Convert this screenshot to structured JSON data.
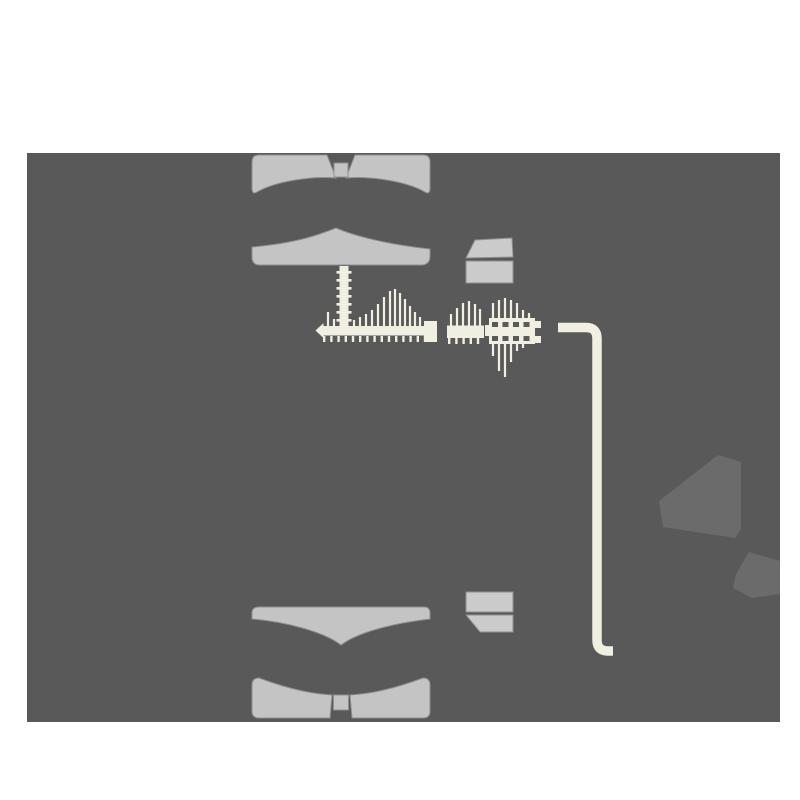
{
  "meta": {
    "description": "Exploded hardware assembly diagram of a clamp / mount kit on a dark panel",
    "canvas_width": 800,
    "canvas_height": 800,
    "text_visible": false
  },
  "colors": {
    "page_bg": "#ffffff",
    "panel_bg": "#595959",
    "part_gray": "#c4c4c4",
    "block_gray": "#cbcbcb",
    "hardware_cream": "#f1eee2",
    "shadow_gray": "#6b6b6b"
  },
  "parts": [
    {
      "id": "top-clamp-outer",
      "kind": "bowtie-pad"
    },
    {
      "id": "top-clamp-inner",
      "kind": "peaked-plate"
    },
    {
      "id": "vertical-machine-screw",
      "kind": "threaded-rod"
    },
    {
      "id": "horizontal-lag-screw",
      "kind": "threaded-screw"
    },
    {
      "id": "thread-nut",
      "kind": "nut"
    },
    {
      "id": "short-screw-segment",
      "kind": "threaded-screw"
    },
    {
      "id": "ribbed-wall-anchor",
      "kind": "anchor-plug"
    },
    {
      "id": "spacer-block-top",
      "kind": "block-3d"
    },
    {
      "id": "hex-key",
      "kind": "allen-wrench"
    },
    {
      "id": "spacer-block-bottom",
      "kind": "block-3d"
    },
    {
      "id": "bottom-clamp-inner",
      "kind": "winged-plate"
    },
    {
      "id": "bottom-clamp-outer",
      "kind": "bowtie-pad"
    },
    {
      "id": "shadow-large",
      "kind": "shadow"
    },
    {
      "id": "shadow-small",
      "kind": "shadow"
    }
  ]
}
